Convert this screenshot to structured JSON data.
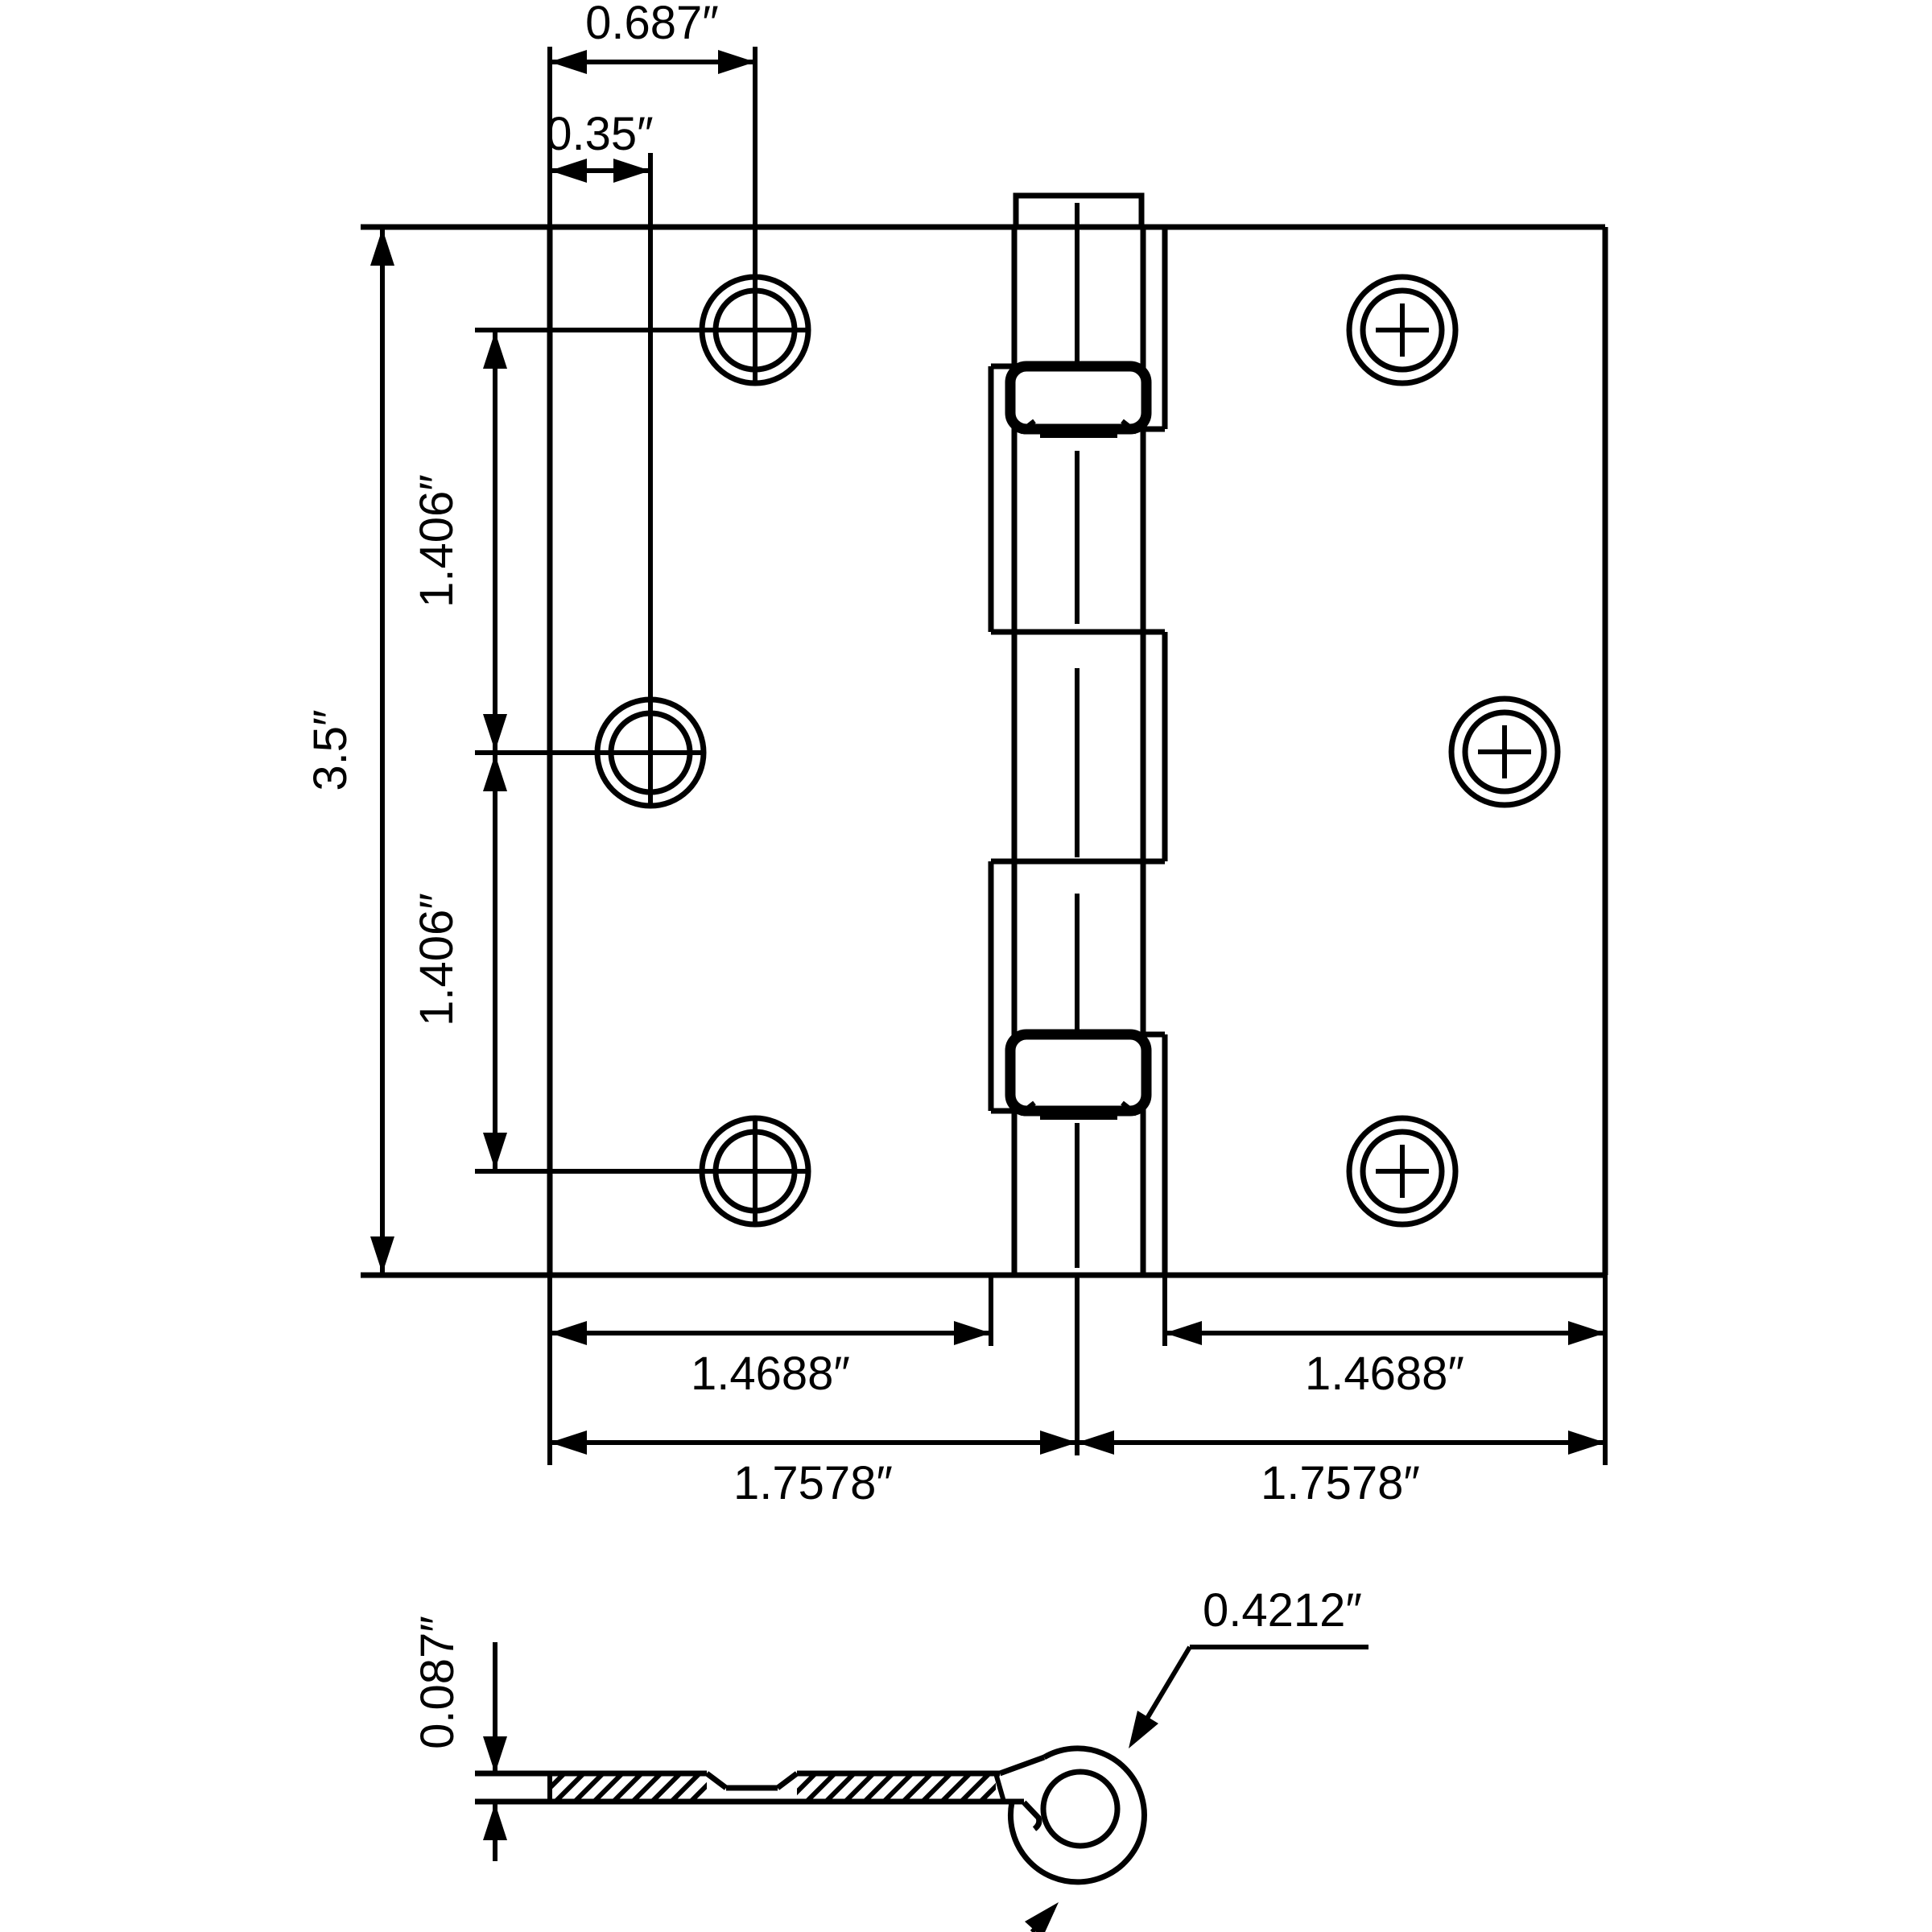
{
  "drawing_title": "3.5 inch square corner door hinge dimension drawing",
  "colors": {
    "line": "#000000",
    "background": "#ffffff"
  },
  "front_view": {
    "top_hole_offset": "0.687″",
    "middle_hole_offset": "0.35″",
    "height": "3.5″",
    "hole_spacing_upper": "1.406″",
    "hole_spacing_lower": "1.406″",
    "left_leaf_width": "1.4688″",
    "right_leaf_width": "1.4688″",
    "left_half_width": "1.7578″",
    "right_half_width": "1.7578″"
  },
  "side_view": {
    "leaf_thickness": "0.087″",
    "barrel_diameter": "0.4212″"
  }
}
